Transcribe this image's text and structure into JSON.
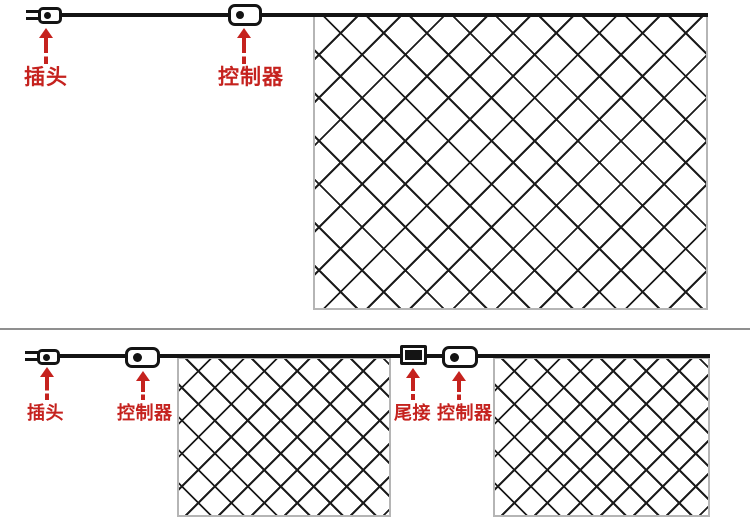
{
  "diagram": {
    "description": "LED net light wiring diagram with two configurations",
    "colors": {
      "label_red": "#c5221e",
      "wire_black": "#141414",
      "net_border_gray": "#b5b5b5",
      "divider_gray": "#8f8f8f",
      "background": "#ffffff"
    },
    "single_net_section": {
      "labels": {
        "plug": "插头",
        "controller": "控制器"
      }
    },
    "double_net_section": {
      "labels": {
        "plug": "插头",
        "controller": "控制器",
        "tail_connector": "尾接",
        "controller_2": "控制器"
      }
    }
  }
}
